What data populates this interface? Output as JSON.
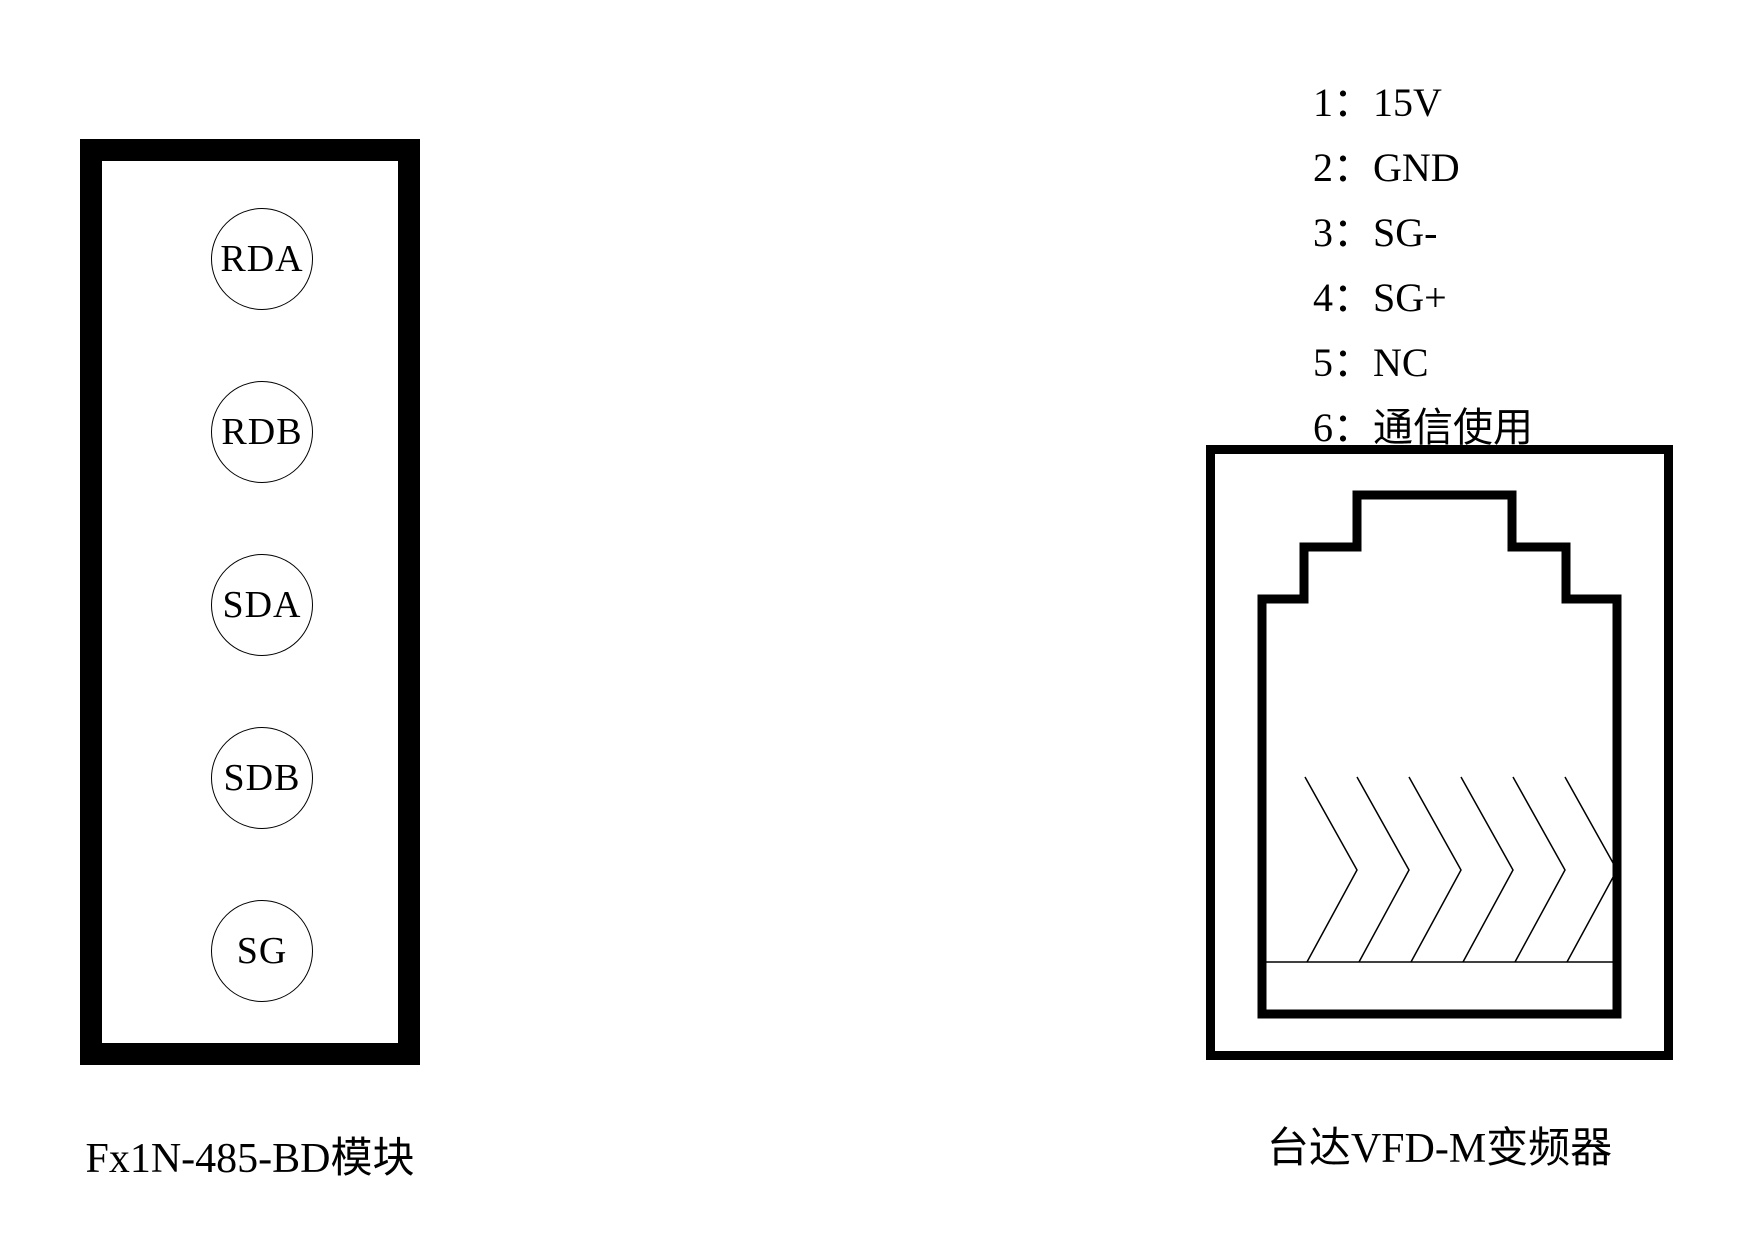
{
  "page": {
    "background_color": "#ffffff",
    "ink_color": "#000000"
  },
  "left_module": {
    "caption": "Fx1N-485-BD模块",
    "pins": [
      "RDA",
      "RDB",
      "SDA",
      "SDB",
      "SG"
    ]
  },
  "right_device": {
    "caption": "台达VFD-M变频器",
    "pin_list": [
      "1：15V",
      "2：GND",
      "3：SG-",
      "4：SG+",
      "5：NC",
      "6：通信使用"
    ]
  }
}
